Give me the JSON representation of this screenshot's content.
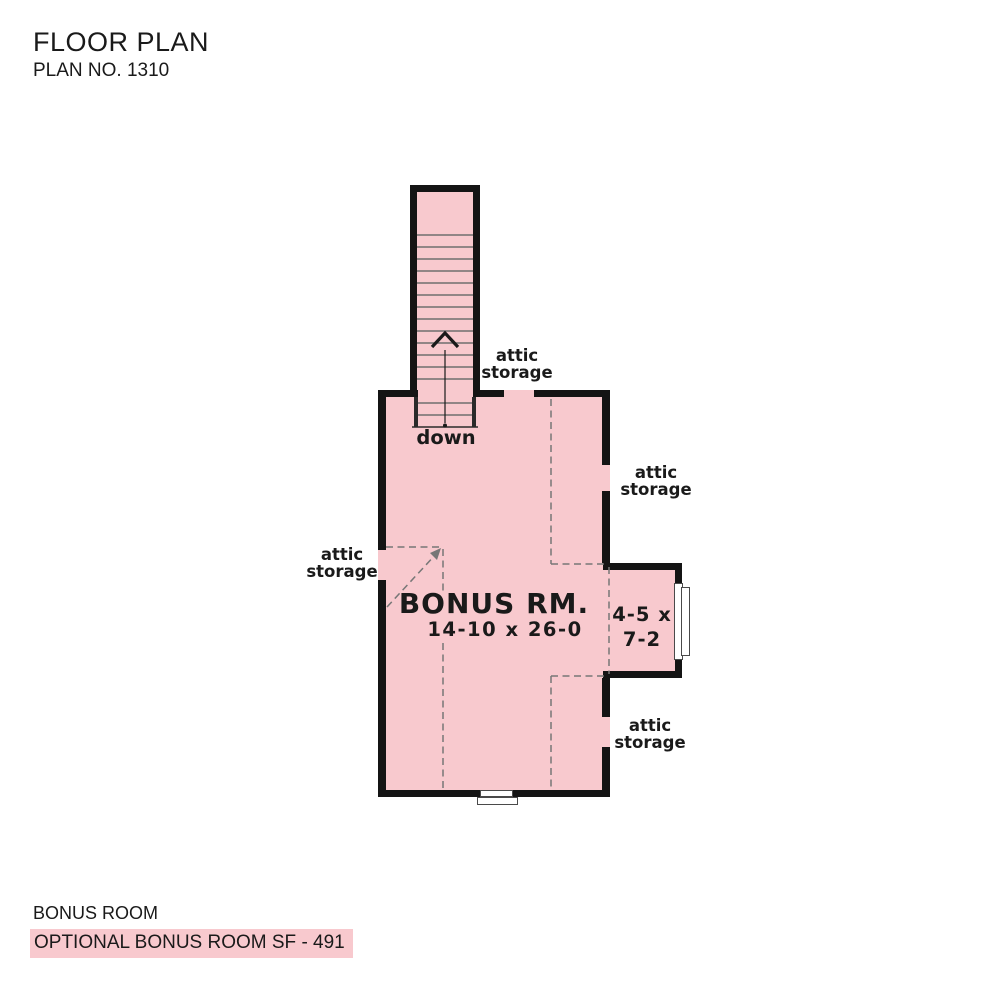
{
  "header": {
    "title": "FLOOR PLAN",
    "plan_number": "PLAN NO. 1310"
  },
  "plan": {
    "bonus_room": {
      "name": "BONUS RM.",
      "dimensions": "14-10 x 26-0"
    },
    "alcove": {
      "dimensions_line1": "4-5 x",
      "dimensions_line2": "7-2"
    },
    "stairs": {
      "label": "down"
    },
    "attic_labels": [
      {
        "line1": "attic",
        "line2": "storage"
      },
      {
        "line1": "attic",
        "line2": "storage"
      },
      {
        "line1": "attic",
        "line2": "storage"
      },
      {
        "line1": "attic",
        "line2": "storage"
      }
    ]
  },
  "footer": {
    "room_name": "BONUS ROOM",
    "highlight_note": "OPTIONAL BONUS ROOM SF - 491"
  },
  "colors": {
    "room_fill": "#f8c9ce",
    "wall": "#141414",
    "highlight": "#f8c9ce",
    "dashed_line": "#777777",
    "text": "#1a1a1a"
  }
}
